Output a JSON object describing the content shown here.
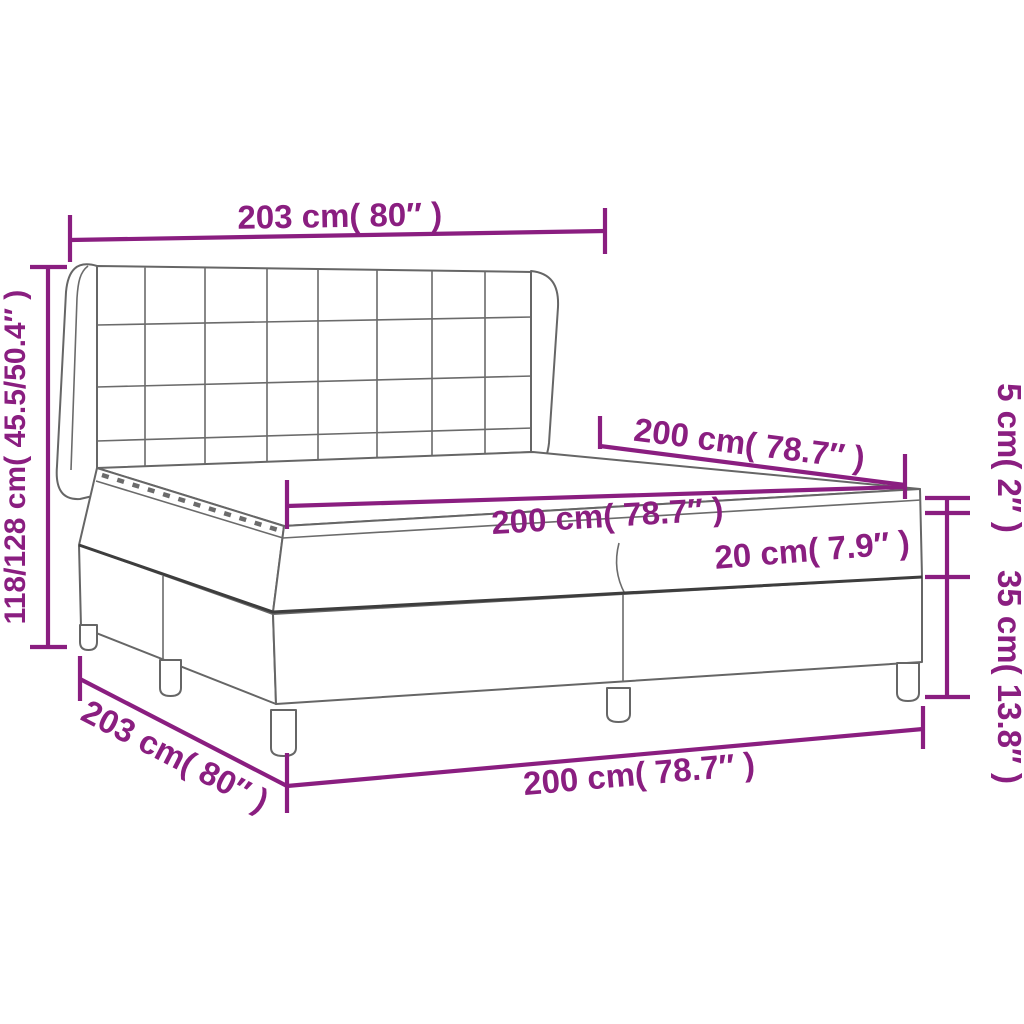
{
  "diagram": {
    "kind": "product-dimension-diagram",
    "accent_color": "#8a1e80",
    "outline_color": "#666666",
    "background_color": "#ffffff",
    "dimensions": {
      "headboard_width": {
        "label": "203 cm( 80″ )"
      },
      "overall_height": {
        "label": "118/128 cm( 45.5/50.4″ )"
      },
      "bed_length": {
        "label": "200 cm( 78.7″ )"
      },
      "mattress_width": {
        "label": "200 cm( 78.7″ )"
      },
      "mattress_thickness": {
        "label": "20 cm( 7.9″ )"
      },
      "topper_thickness": {
        "label": "5 cm( 2″ )"
      },
      "base_height": {
        "label": "35 cm( 13.8″ )"
      },
      "base_length": {
        "label": "203 cm( 80″ )"
      },
      "base_width": {
        "label": "200 cm( 78.7″ )"
      }
    }
  }
}
